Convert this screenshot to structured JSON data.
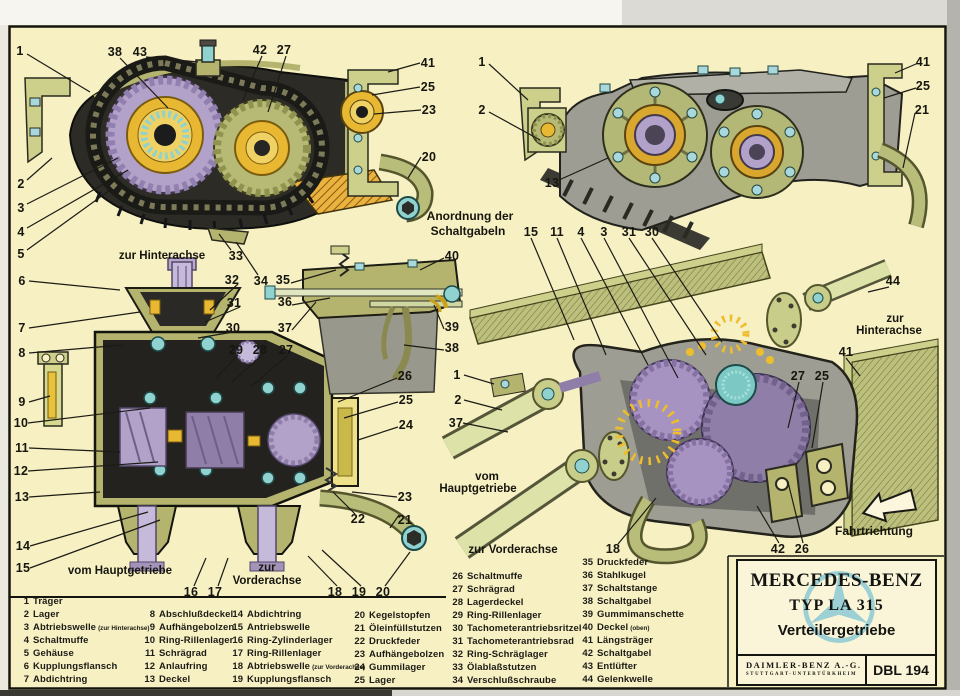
{
  "title_block": {
    "brand": "MERCEDES-BENZ",
    "model": "TYP LA 315",
    "subtitle": "Verteilergetriebe",
    "manufacturer": "DAIMLER-BENZ A.-G.",
    "manufacturer_sub": "STUTTGART-UNTERTÜRKHEIM",
    "doc_number": "DBL 194"
  },
  "palette": {
    "paper_cream": "#f6f0c3",
    "box_cream": "#faf5d9",
    "star_blue": "#9cd0d4",
    "olive_metal": "#b5b46e",
    "pale_green_shaft": "#dde2a8",
    "gear_lilac": "#b2a2ca",
    "bearing_teal": "#8fd2cf",
    "bolt_blue": "#a8d8dc",
    "seal_yellow": "#e8b832",
    "oil_orange": "#e8aa3a",
    "housing_gray": "#9d9d93",
    "ink_black": "#1c1b15"
  },
  "callouts": [
    {
      "t": "1",
      "x": 20,
      "y": 51
    },
    {
      "t": "38",
      "x": 115,
      "y": 52
    },
    {
      "t": "43",
      "x": 140,
      "y": 52
    },
    {
      "t": "42",
      "x": 260,
      "y": 50
    },
    {
      "t": "27",
      "x": 284,
      "y": 50
    },
    {
      "t": "2",
      "x": 21,
      "y": 184
    },
    {
      "t": "3",
      "x": 21,
      "y": 208
    },
    {
      "t": "4",
      "x": 21,
      "y": 232
    },
    {
      "t": "5",
      "x": 21,
      "y": 254
    },
    {
      "t": "41",
      "x": 428,
      "y": 63
    },
    {
      "t": "25",
      "x": 428,
      "y": 87
    },
    {
      "t": "23",
      "x": 429,
      "y": 110
    },
    {
      "t": "20",
      "x": 429,
      "y": 157
    },
    {
      "t": "33",
      "x": 236,
      "y": 256
    },
    {
      "t": "34",
      "x": 261,
      "y": 281
    },
    {
      "t": "zur Hinterachse",
      "x": 162,
      "y": 256,
      "cls": "cap"
    },
    {
      "t": "6",
      "x": 22,
      "y": 281
    },
    {
      "t": "7",
      "x": 22,
      "y": 328
    },
    {
      "t": "8",
      "x": 22,
      "y": 353
    },
    {
      "t": "9",
      "x": 22,
      "y": 402
    },
    {
      "t": "10",
      "x": 21,
      "y": 423
    },
    {
      "t": "11",
      "x": 22,
      "y": 448
    },
    {
      "t": "12",
      "x": 21,
      "y": 471
    },
    {
      "t": "13",
      "x": 22,
      "y": 497
    },
    {
      "t": "14",
      "x": 23,
      "y": 546
    },
    {
      "t": "15",
      "x": 23,
      "y": 568
    },
    {
      "t": "32",
      "x": 232,
      "y": 280
    },
    {
      "t": "31",
      "x": 234,
      "y": 303
    },
    {
      "t": "30",
      "x": 233,
      "y": 328
    },
    {
      "t": "29",
      "x": 236,
      "y": 350
    },
    {
      "t": "28",
      "x": 260,
      "y": 350
    },
    {
      "t": "27",
      "x": 286,
      "y": 350
    },
    {
      "t": "26",
      "x": 405,
      "y": 376
    },
    {
      "t": "25",
      "x": 406,
      "y": 400
    },
    {
      "t": "24",
      "x": 406,
      "y": 425
    },
    {
      "t": "23",
      "x": 405,
      "y": 497
    },
    {
      "t": "22",
      "x": 358,
      "y": 519
    },
    {
      "t": "21",
      "x": 405,
      "y": 520
    },
    {
      "t": "16",
      "x": 191,
      "y": 592
    },
    {
      "t": "17",
      "x": 215,
      "y": 592
    },
    {
      "t": "18",
      "x": 335,
      "y": 592
    },
    {
      "t": "19",
      "x": 359,
      "y": 592
    },
    {
      "t": "20",
      "x": 383,
      "y": 592
    },
    {
      "t": "vom Hauptgetriebe",
      "x": 120,
      "y": 571,
      "cls": "cap"
    },
    {
      "t": "zur",
      "x": 267,
      "y": 568,
      "cls": "cap"
    },
    {
      "t": "Vorderachse",
      "x": 267,
      "y": 581,
      "cls": "cap"
    },
    {
      "t": "Anordnung der",
      "x": 470,
      "y": 216,
      "cls": "cap2"
    },
    {
      "t": "Schaltgabeln",
      "x": 468,
      "y": 231,
      "cls": "cap2"
    },
    {
      "t": "35",
      "x": 283,
      "y": 280
    },
    {
      "t": "36",
      "x": 285,
      "y": 302
    },
    {
      "t": "37",
      "x": 285,
      "y": 328
    },
    {
      "t": "40",
      "x": 452,
      "y": 256
    },
    {
      "t": "39",
      "x": 452,
      "y": 327
    },
    {
      "t": "38",
      "x": 452,
      "y": 348
    },
    {
      "t": "1",
      "x": 482,
      "y": 62
    },
    {
      "t": "2",
      "x": 482,
      "y": 110
    },
    {
      "t": "13",
      "x": 552,
      "y": 183
    },
    {
      "t": "41",
      "x": 923,
      "y": 62
    },
    {
      "t": "25",
      "x": 923,
      "y": 86
    },
    {
      "t": "21",
      "x": 922,
      "y": 110
    },
    {
      "t": "15",
      "x": 531,
      "y": 232
    },
    {
      "t": "11",
      "x": 557,
      "y": 232
    },
    {
      "t": "4",
      "x": 581,
      "y": 232
    },
    {
      "t": "3",
      "x": 604,
      "y": 232
    },
    {
      "t": "31",
      "x": 629,
      "y": 232
    },
    {
      "t": "30",
      "x": 652,
      "y": 232
    },
    {
      "t": "44",
      "x": 893,
      "y": 281
    },
    {
      "t": "41",
      "x": 846,
      "y": 352
    },
    {
      "t": "27",
      "x": 798,
      "y": 376
    },
    {
      "t": "25",
      "x": 822,
      "y": 376
    },
    {
      "t": "1",
      "x": 457,
      "y": 375
    },
    {
      "t": "2",
      "x": 458,
      "y": 400
    },
    {
      "t": "37",
      "x": 456,
      "y": 423
    },
    {
      "t": "18",
      "x": 613,
      "y": 549
    },
    {
      "t": "42",
      "x": 778,
      "y": 549
    },
    {
      "t": "26",
      "x": 802,
      "y": 549
    },
    {
      "t": "zur",
      "x": 895,
      "y": 319,
      "cls": "cap"
    },
    {
      "t": "Hinterachse",
      "x": 889,
      "y": 331,
      "cls": "cap"
    },
    {
      "t": "vom",
      "x": 487,
      "y": 477,
      "cls": "cap"
    },
    {
      "t": "Hauptgetriebe",
      "x": 478,
      "y": 489,
      "cls": "cap"
    },
    {
      "t": "zur Vorderachse",
      "x": 513,
      "y": 550,
      "cls": "cap"
    },
    {
      "t": "Fahrtrichtung",
      "x": 874,
      "y": 531,
      "cls": "cap2"
    }
  ],
  "legend": {
    "columns": [
      {
        "items": [
          {
            "n": "1",
            "label": "Träger"
          },
          {
            "n": "2",
            "label": "Lager"
          },
          {
            "n": "3",
            "label": "Abtriebswelle",
            "note": "(zur Hinterachse)"
          },
          {
            "n": "4",
            "label": "Schaltmuffe"
          },
          {
            "n": "5",
            "label": "Gehäuse"
          },
          {
            "n": "6",
            "label": "Kupplungsflansch"
          },
          {
            "n": "7",
            "label": "Abdichtring"
          }
        ]
      },
      {
        "items": [
          {
            "n": "8",
            "label": "Abschlußdeckel"
          },
          {
            "n": "9",
            "label": "Aufhängebolzen"
          },
          {
            "n": "10",
            "label": "Ring-Rillenlager"
          },
          {
            "n": "11",
            "label": "Schrägrad"
          },
          {
            "n": "12",
            "label": "Anlaufring"
          },
          {
            "n": "13",
            "label": "Deckel"
          }
        ]
      },
      {
        "items": [
          {
            "n": "14",
            "label": "Abdichtring"
          },
          {
            "n": "15",
            "label": "Antriebswelle"
          },
          {
            "n": "16",
            "label": "Ring-Zylinderlager"
          },
          {
            "n": "17",
            "label": "Ring-Rillenlager"
          },
          {
            "n": "18",
            "label": "Abtriebswelle",
            "note": "(zur Vorderachse)"
          },
          {
            "n": "19",
            "label": "Kupplungsflansch"
          }
        ]
      },
      {
        "items": [
          {
            "n": "20",
            "label": "Kegelstopfen"
          },
          {
            "n": "21",
            "label": "Öleinfüllstutzen"
          },
          {
            "n": "22",
            "label": "Druckfeder"
          },
          {
            "n": "23",
            "label": "Aufhängebolzen"
          },
          {
            "n": "24",
            "label": "Gummilager"
          },
          {
            "n": "25",
            "label": "Lager"
          }
        ]
      },
      {
        "items": [
          {
            "n": "26",
            "label": "Schaltmuffe"
          },
          {
            "n": "27",
            "label": "Schrägrad"
          },
          {
            "n": "28",
            "label": "Lagerdeckel"
          },
          {
            "n": "29",
            "label": "Ring-Rillenlager"
          },
          {
            "n": "30",
            "label": "Tachometerantriebsritzel"
          },
          {
            "n": "31",
            "label": "Tachometerantriebsrad"
          },
          {
            "n": "32",
            "label": "Ring-Schräglager"
          },
          {
            "n": "33",
            "label": "Ölablaßstutzen"
          },
          {
            "n": "34",
            "label": "Verschlußschraube"
          }
        ]
      },
      {
        "items": [
          {
            "n": "35",
            "label": "Druckfeder"
          },
          {
            "n": "36",
            "label": "Stahlkugel"
          },
          {
            "n": "37",
            "label": "Schaltstange"
          },
          {
            "n": "38",
            "label": "Schaltgabel"
          },
          {
            "n": "39",
            "label": "Gummimanschette"
          },
          {
            "n": "40",
            "label": "Deckel",
            "note": "(oben)"
          },
          {
            "n": "41",
            "label": "Längsträger"
          },
          {
            "n": "42",
            "label": "Schaltgabel"
          },
          {
            "n": "43",
            "label": "Entlüfter"
          },
          {
            "n": "44",
            "label": "Gelenkwelle"
          }
        ]
      }
    ]
  }
}
